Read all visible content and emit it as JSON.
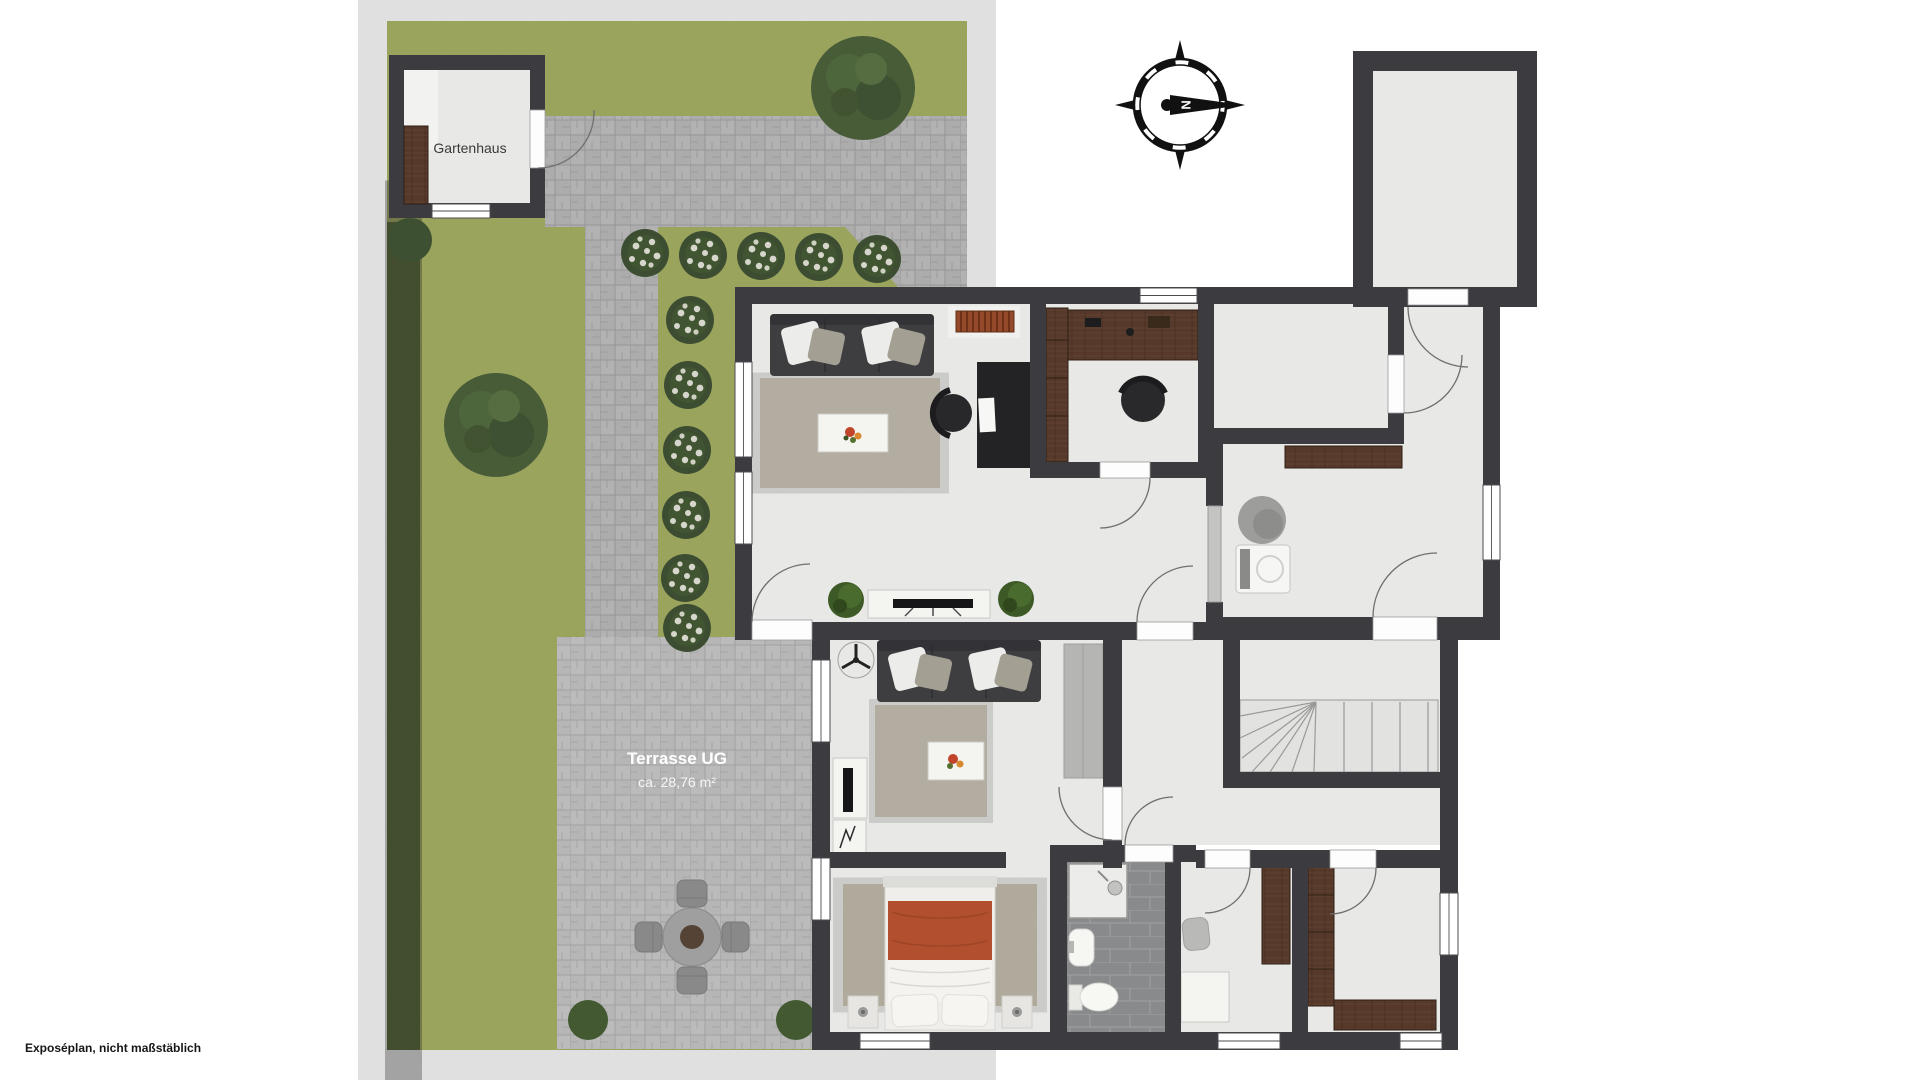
{
  "labels": {
    "garden_house": "Gartenhaus",
    "terrace_title": "Terrasse UG",
    "terrace_area": "ca. 28,76 m²",
    "compass_north": "N",
    "disclaimer": "Exposéplan, nicht maßstäblich"
  },
  "colors": {
    "wall": "#3c3c40",
    "floor": "#e8e8e6",
    "lawn": "#a6b257",
    "hedge": "#4c6127",
    "paver": "#bcbcbc",
    "terrace_paver": "#c9c9c9",
    "bathroom_tile": "#a2a3a6",
    "wood": "#56392a",
    "sofa": "#3e3e41",
    "rug": "#cdc6b8",
    "bed_cover": "#b14f2e",
    "radiator": "#93492a"
  }
}
